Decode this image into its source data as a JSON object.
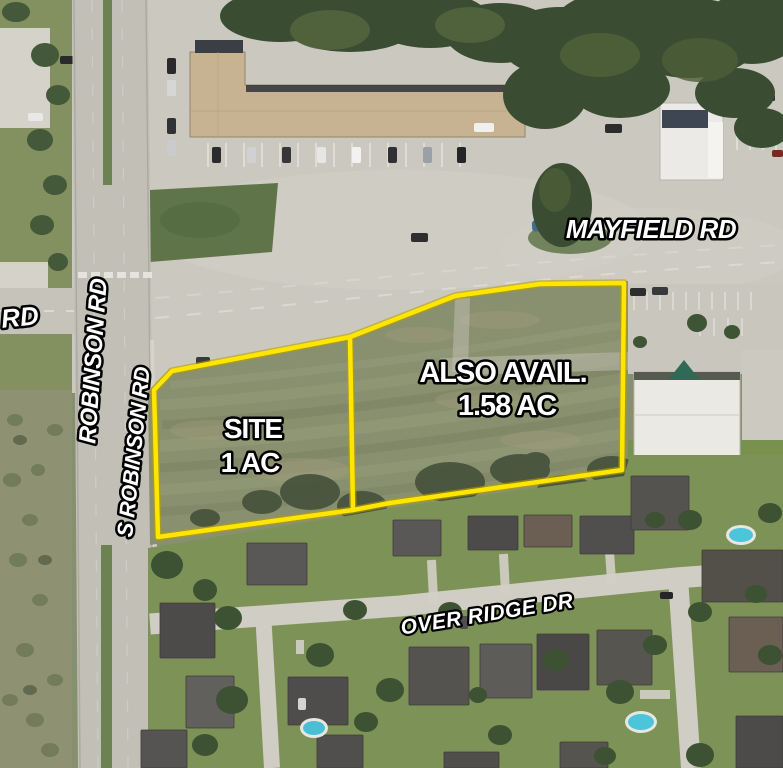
{
  "roads": {
    "mayfield": "MAYFIELD RD",
    "robinson": "ROBINSON RD",
    "s_robinson": "S ROBINSON RD",
    "west_partial": "RD",
    "over_ridge": "OVER RIDGE DR"
  },
  "parcels": {
    "site": {
      "name": "SITE",
      "area": "1 AC"
    },
    "also_avail": {
      "name": "ALSO AVAIL.",
      "area": "1.58 AC"
    },
    "outline_color": "#ffe600"
  },
  "label_colors": {
    "fill": "#ffffff",
    "outline": "#000000"
  }
}
